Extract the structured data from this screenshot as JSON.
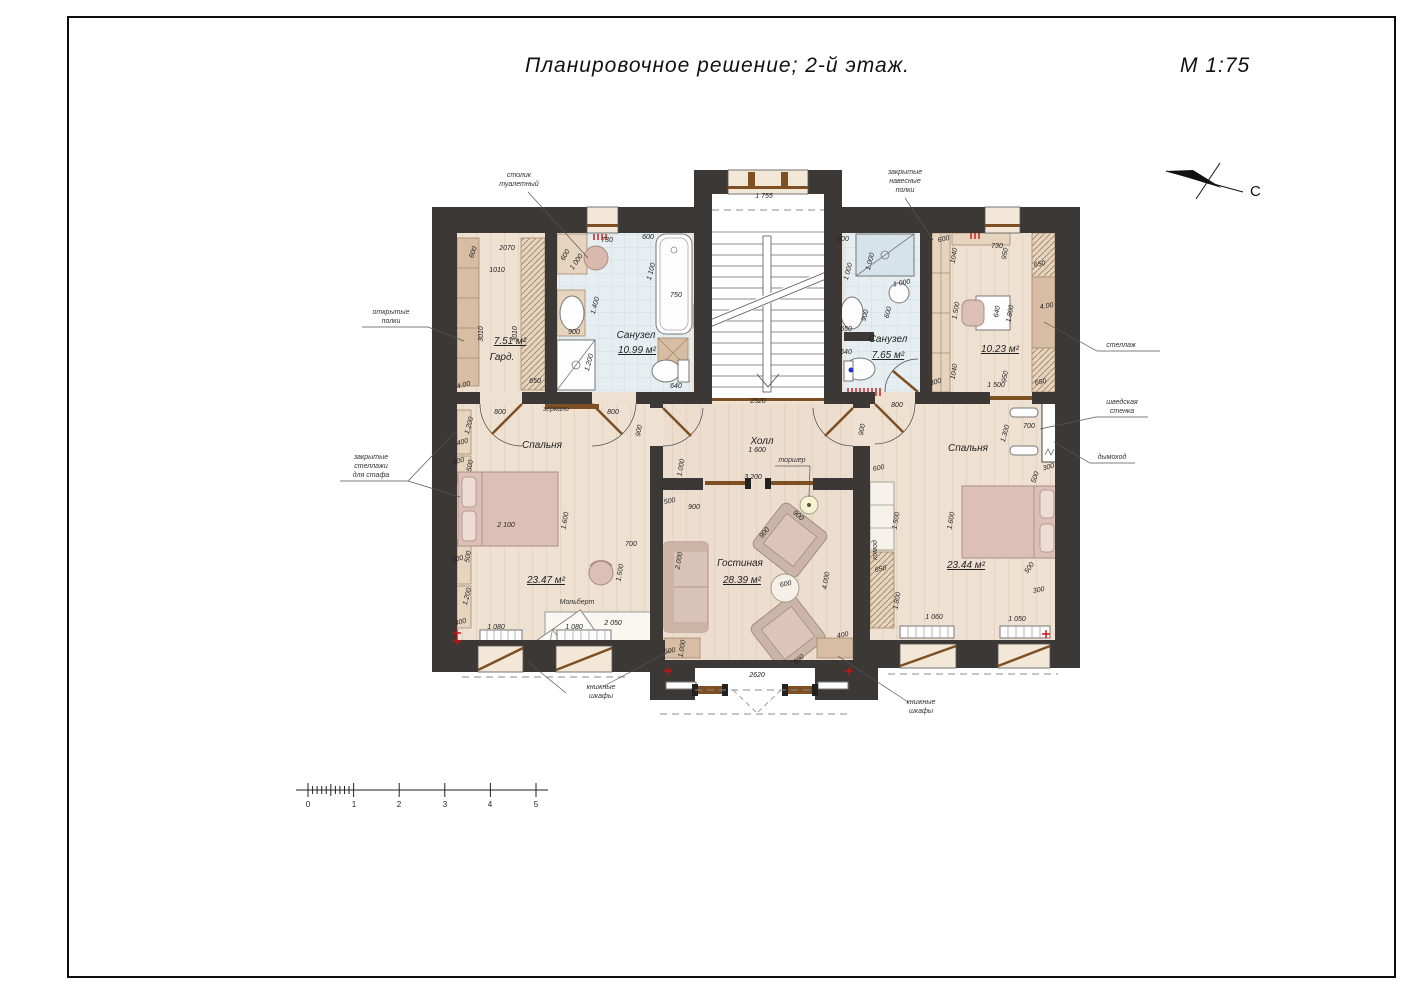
{
  "title": "Планировочное  решение;  2-й  этаж.",
  "scale_note": "М  1:75",
  "north_label": "С",
  "plan": {
    "floor": "2-й этаж",
    "drawing_scale": "1:75",
    "rooms": [
      {
        "name": "Гард.",
        "area_m2": "7.51 м²"
      },
      {
        "name": "Санузел",
        "area_m2": "10.99 м²"
      },
      {
        "name": "Санузел",
        "area_m2": "7.65 м²"
      },
      {
        "name": "Кабинет",
        "area_m2": "10.23 м²"
      },
      {
        "name": "Спальня",
        "area_m2": "23.47 м²"
      },
      {
        "name": "Холл",
        "area_m2": ""
      },
      {
        "name": "Гостиная",
        "area_m2": "28.39 м²"
      },
      {
        "name": "Спальня",
        "area_m2": "23.44 м²"
      }
    ]
  },
  "labels": {
    "room": [
      {
        "t": "Гард.",
        "x": 502,
        "y": 360
      },
      {
        "t": "7.51 м²",
        "x": 510,
        "y": 344,
        "s": 8.5,
        "u": 1
      },
      {
        "t": "Санузел",
        "x": 636,
        "y": 338
      },
      {
        "t": "10.99 м²",
        "x": 637,
        "y": 353,
        "s": 8.5,
        "u": 1
      },
      {
        "t": "Санузел",
        "x": 888,
        "y": 342
      },
      {
        "t": "7.65 м²",
        "x": 888,
        "y": 358,
        "s": 8.5,
        "u": 1
      },
      {
        "t": "10.23 м²",
        "x": 1000,
        "y": 352,
        "s": 8.5,
        "u": 1
      },
      {
        "t": "Спальня",
        "x": 542,
        "y": 448
      },
      {
        "t": "23.47 м²",
        "x": 546,
        "y": 583,
        "s": 8.5,
        "u": 1
      },
      {
        "t": "Холл",
        "x": 762,
        "y": 444
      },
      {
        "t": "Гостиная",
        "x": 740,
        "y": 566
      },
      {
        "t": "28.39 м²",
        "x": 742,
        "y": 583,
        "s": 8.5,
        "u": 1
      },
      {
        "t": "Спальня",
        "x": 968,
        "y": 451
      },
      {
        "t": "23.44 м²",
        "x": 966,
        "y": 568,
        "s": 8.5,
        "u": 1
      }
    ],
    "ann": [
      {
        "t": "столик",
        "x": 519,
        "y": 177
      },
      {
        "t": "туалетный",
        "x": 519,
        "y": 186
      },
      {
        "t": "закрытые",
        "x": 905,
        "y": 174
      },
      {
        "t": "навесные",
        "x": 905,
        "y": 183
      },
      {
        "t": "полки",
        "x": 905,
        "y": 192
      },
      {
        "t": "открытые",
        "x": 391,
        "y": 314
      },
      {
        "t": "полки",
        "x": 391,
        "y": 323
      },
      {
        "t": "закрытые",
        "x": 371,
        "y": 459
      },
      {
        "t": "стеллажи",
        "x": 371,
        "y": 468
      },
      {
        "t": "для стафа",
        "x": 371,
        "y": 477
      },
      {
        "t": "стеллаж",
        "x": 1121,
        "y": 347
      },
      {
        "t": "шведская",
        "x": 1122,
        "y": 404
      },
      {
        "t": "стенка",
        "x": 1122,
        "y": 413
      },
      {
        "t": "дымоход",
        "x": 1112,
        "y": 459
      },
      {
        "t": "книжные",
        "x": 601,
        "y": 689
      },
      {
        "t": "шкафы",
        "x": 601,
        "y": 698
      },
      {
        "t": "книжные",
        "x": 921,
        "y": 704
      },
      {
        "t": "шкафы",
        "x": 921,
        "y": 713
      },
      {
        "t": "зеркало",
        "x": 556,
        "y": 411,
        "s": 6
      },
      {
        "t": "торшер",
        "x": 792,
        "y": 462
      },
      {
        "t": "Мольберт",
        "x": 577,
        "y": 604
      },
      {
        "t": "комод",
        "x": 877,
        "y": 550,
        "r": -90,
        "s": 6
      }
    ],
    "dim": [
      {
        "t": "600",
        "x": 475,
        "y": 253,
        "r": -70
      },
      {
        "t": "2070",
        "x": 507,
        "y": 250
      },
      {
        "t": "1010",
        "x": 497,
        "y": 272
      },
      {
        "t": "3010",
        "x": 483,
        "y": 334,
        "r": -90
      },
      {
        "t": "3010",
        "x": 517,
        "y": 334,
        "r": -90
      },
      {
        "t": "4.00",
        "x": 464,
        "y": 387,
        "r": -15
      },
      {
        "t": "650",
        "x": 535,
        "y": 383
      },
      {
        "t": "730",
        "x": 607,
        "y": 242
      },
      {
        "t": "600",
        "x": 648,
        "y": 239
      },
      {
        "t": "600",
        "x": 567,
        "y": 256,
        "r": -60
      },
      {
        "t": "1 000",
        "x": 578,
        "y": 263,
        "r": -55
      },
      {
        "t": "1 100",
        "x": 653,
        "y": 272,
        "r": -75
      },
      {
        "t": "750",
        "x": 676,
        "y": 297
      },
      {
        "t": "1.400",
        "x": 597,
        "y": 306,
        "r": -75
      },
      {
        "t": "900",
        "x": 574,
        "y": 334
      },
      {
        "t": "1.200",
        "x": 591,
        "y": 363,
        "r": -75
      },
      {
        "t": "640",
        "x": 676,
        "y": 388
      },
      {
        "t": "1 755",
        "x": 764,
        "y": 198
      },
      {
        "t": "2520",
        "x": 758,
        "y": 403
      },
      {
        "t": "600",
        "x": 843,
        "y": 241
      },
      {
        "t": "1 000",
        "x": 850,
        "y": 272,
        "r": -75
      },
      {
        "t": "1.000",
        "x": 872,
        "y": 262,
        "r": -75
      },
      {
        "t": "1 000",
        "x": 902,
        "y": 285,
        "r": -10
      },
      {
        "t": "600",
        "x": 890,
        "y": 313,
        "r": -75
      },
      {
        "t": "900",
        "x": 867,
        "y": 316,
        "r": -75
      },
      {
        "t": "650",
        "x": 846,
        "y": 331
      },
      {
        "t": "640",
        "x": 846,
        "y": 354
      },
      {
        "t": "300",
        "x": 936,
        "y": 384,
        "r": -15
      },
      {
        "t": "800",
        "x": 897,
        "y": 407
      },
      {
        "t": "600",
        "x": 944,
        "y": 241,
        "r": -12
      },
      {
        "t": "1040",
        "x": 956,
        "y": 256,
        "r": -80
      },
      {
        "t": "730",
        "x": 997,
        "y": 248
      },
      {
        "t": "950",
        "x": 1007,
        "y": 254,
        "r": -80
      },
      {
        "t": "650",
        "x": 1040,
        "y": 266,
        "r": -10
      },
      {
        "t": "1.500",
        "x": 958,
        "y": 311,
        "r": -80
      },
      {
        "t": "640",
        "x": 999,
        "y": 312,
        "r": -80
      },
      {
        "t": "1.800",
        "x": 1012,
        "y": 314,
        "r": -80
      },
      {
        "t": "4.00",
        "x": 1047,
        "y": 308,
        "r": -10
      },
      {
        "t": "1040",
        "x": 956,
        "y": 372,
        "r": -80
      },
      {
        "t": "950",
        "x": 1007,
        "y": 377,
        "r": -80
      },
      {
        "t": "1 500",
        "x": 996,
        "y": 387
      },
      {
        "t": "650",
        "x": 1041,
        "y": 384,
        "r": -10
      },
      {
        "t": "800",
        "x": 500,
        "y": 414
      },
      {
        "t": "800",
        "x": 613,
        "y": 414
      },
      {
        "t": "900",
        "x": 641,
        "y": 431,
        "r": -80
      },
      {
        "t": "1.200",
        "x": 471,
        "y": 426,
        "r": -75
      },
      {
        "t": "400",
        "x": 463,
        "y": 444,
        "r": -15
      },
      {
        "t": "300",
        "x": 459,
        "y": 463,
        "r": -15
      },
      {
        "t": "500",
        "x": 472,
        "y": 466,
        "r": -80
      },
      {
        "t": "2 100",
        "x": 506,
        "y": 527
      },
      {
        "t": "1.600",
        "x": 567,
        "y": 521,
        "r": -80
      },
      {
        "t": "300",
        "x": 458,
        "y": 561,
        "r": -15
      },
      {
        "t": "500",
        "x": 470,
        "y": 557,
        "r": -80
      },
      {
        "t": "1.200",
        "x": 469,
        "y": 597,
        "r": -75
      },
      {
        "t": "400",
        "x": 461,
        "y": 624,
        "r": -15
      },
      {
        "t": "1 080",
        "x": 496,
        "y": 629
      },
      {
        "t": "1 080",
        "x": 574,
        "y": 629
      },
      {
        "t": "2 050",
        "x": 613,
        "y": 625
      },
      {
        "t": "700",
        "x": 631,
        "y": 546
      },
      {
        "t": "1.500",
        "x": 622,
        "y": 573,
        "r": -80
      },
      {
        "t": "3 200",
        "x": 753,
        "y": 479
      },
      {
        "t": "1 600",
        "x": 757,
        "y": 452
      },
      {
        "t": "1.000",
        "x": 683,
        "y": 468,
        "r": -80
      },
      {
        "t": "500",
        "x": 670,
        "y": 503,
        "r": -10
      },
      {
        "t": "900",
        "x": 694,
        "y": 509
      },
      {
        "t": "2.000",
        "x": 681,
        "y": 561,
        "r": -80
      },
      {
        "t": "900",
        "x": 797,
        "y": 517,
        "r": 40
      },
      {
        "t": "900",
        "x": 766,
        "y": 534,
        "r": -50
      },
      {
        "t": "600",
        "x": 786,
        "y": 586,
        "r": -10
      },
      {
        "t": "4.000",
        "x": 828,
        "y": 581,
        "r": -80
      },
      {
        "t": "1.000",
        "x": 684,
        "y": 649,
        "r": -80
      },
      {
        "t": "500",
        "x": 670,
        "y": 653,
        "r": -10
      },
      {
        "t": "400",
        "x": 843,
        "y": 637,
        "r": -10
      },
      {
        "t": "900",
        "x": 800,
        "y": 661,
        "r": -40
      },
      {
        "t": "2620",
        "x": 757,
        "y": 677
      },
      {
        "t": "900",
        "x": 864,
        "y": 430,
        "r": -80
      },
      {
        "t": "600",
        "x": 879,
        "y": 470,
        "r": -10
      },
      {
        "t": "1.500",
        "x": 898,
        "y": 521,
        "r": -80
      },
      {
        "t": "650",
        "x": 881,
        "y": 571,
        "r": -10
      },
      {
        "t": "1.800",
        "x": 899,
        "y": 601,
        "r": -80
      },
      {
        "t": "1 060",
        "x": 934,
        "y": 619
      },
      {
        "t": "1 050",
        "x": 1017,
        "y": 621
      },
      {
        "t": "1.600",
        "x": 953,
        "y": 521,
        "r": -80
      },
      {
        "t": "1.300",
        "x": 1007,
        "y": 434,
        "r": -75
      },
      {
        "t": "700",
        "x": 1029,
        "y": 428
      },
      {
        "t": "500",
        "x": 1037,
        "y": 478,
        "r": -70
      },
      {
        "t": "300",
        "x": 1049,
        "y": 469,
        "r": -15
      },
      {
        "t": "500",
        "x": 1031,
        "y": 569,
        "r": -55
      },
      {
        "t": "300",
        "x": 1039,
        "y": 592,
        "r": -10
      }
    ],
    "scale": [
      {
        "t": "0",
        "x": 308,
        "y": 807
      },
      {
        "t": "1",
        "x": 354,
        "y": 807
      },
      {
        "t": "2",
        "x": 399,
        "y": 807
      },
      {
        "t": "3",
        "x": 445,
        "y": 807
      },
      {
        "t": "4",
        "x": 490,
        "y": 807
      },
      {
        "t": "5",
        "x": 536,
        "y": 807
      }
    ]
  },
  "colors": {
    "wall": "#3c3835",
    "floor": "#eee1d2",
    "tile": "#e7eef1",
    "furniture_pink": "#dcc0b6",
    "wood_brown": "#7d4f22",
    "accent_red": "#cc1111"
  }
}
